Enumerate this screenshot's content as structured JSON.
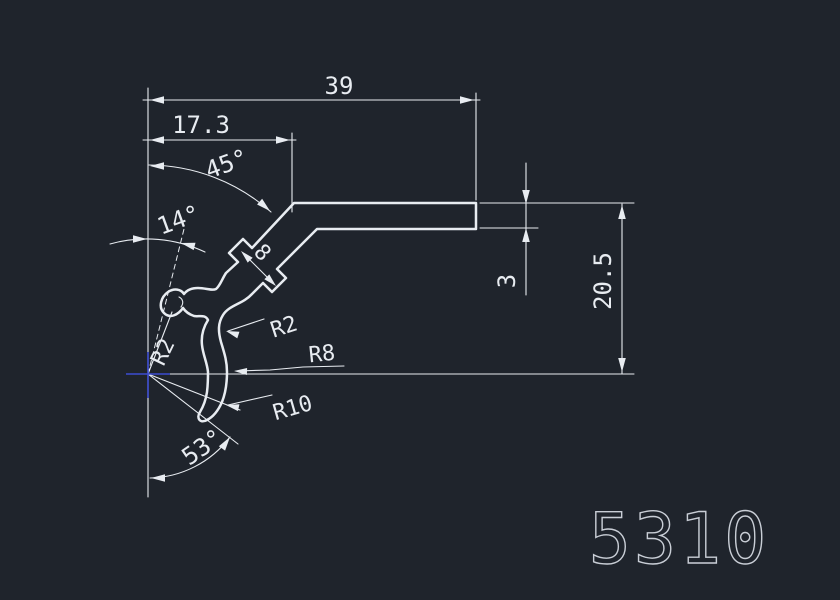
{
  "colors": {
    "background": "#1f242c",
    "line": "#e8ecf1",
    "crosshair": "#3c4cd2",
    "part_number_color": "#c9ced6"
  },
  "part": {
    "number": "5310"
  },
  "dimensions": {
    "total_width": "39",
    "upper_width": "17.3",
    "top_angle": "45°",
    "mid_angle": "14°",
    "tab_gap": "8",
    "wall_thickness": "3",
    "height": "20.5",
    "bottom_angle": "53°",
    "radius_tip": "R2",
    "radius_fillet": "R2",
    "radius_bend": "R8",
    "radius_hook": "R10"
  }
}
